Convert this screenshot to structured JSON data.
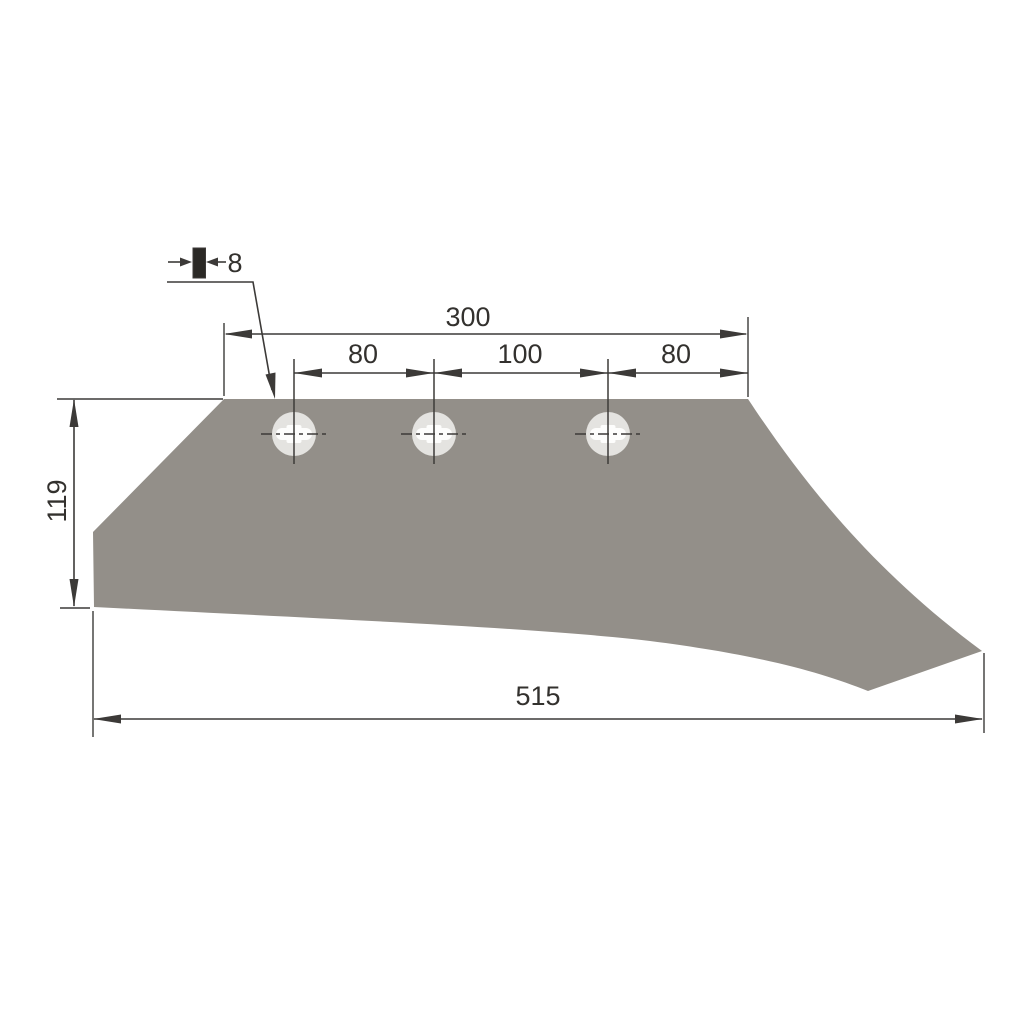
{
  "drawing": {
    "type": "technical-drawing",
    "subject": "plowshare-blade-profile",
    "units_shown": false,
    "dimensions": {
      "top_total": "300",
      "hole_pitch_left": "80",
      "hole_pitch_center": "100",
      "hole_pitch_right": "80",
      "left_height": "119",
      "bottom_total": "515",
      "thickness": "8"
    },
    "holes": {
      "count": 3,
      "style": "carriage-bolt-hole-with-center-marks"
    },
    "colors": {
      "background": "#FFFFFF",
      "part_fill": "#938F89",
      "hole_ring": "#E4E3E0",
      "hole_slot": "#FDFDFC",
      "line": "#3C3A38",
      "text": "#33312E",
      "thickness_bar": "#2B2926"
    }
  }
}
